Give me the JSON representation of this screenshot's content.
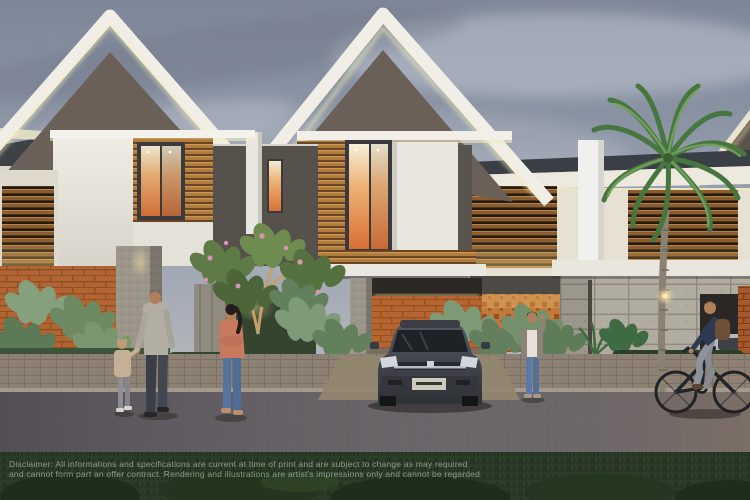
{
  "scene": {
    "caption": "Dusk architectural rendering of modern two-storey tropical townhouses with timber louvres, stone and brick fencing, landscaped frontage, pedestrians, a cyclist and a parked dark sedan"
  },
  "disclaimer": {
    "line1": "Disclaimer: All informations and specifications are current at time of print and are subject to change as may required",
    "line2": "and cannot form part an offer contract. Rendering and illustrations are artist's impressions only and cannot be regarded"
  },
  "palette": {
    "sky": "#939cab",
    "roof_fascia_white": "#f1eee7",
    "gable_wall": "#6a6057",
    "timber": "#b07c3e",
    "brick": "#a6582c",
    "stone": "#b1aca0",
    "foliage": "#55713f",
    "window_glow": "#e8945a",
    "road": "#6b676b",
    "lawn": "#2c3c28",
    "coral_top": "#c87a5f",
    "denim": "#5b79a4",
    "car_body": "#3d4148"
  }
}
